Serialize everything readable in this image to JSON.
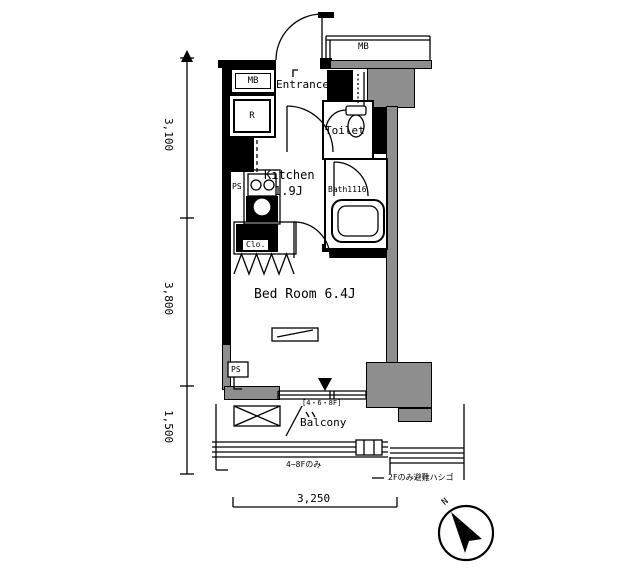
{
  "rooms": {
    "entrance": "Entrance",
    "toilet": "Toilet",
    "kitchen": "Kitchen",
    "kitchen_size": "1.9J",
    "bath": "Bath1116",
    "bedroom": "Bed Room 6.4J",
    "balcony": "Balcony",
    "balcony_floors": "[4・6・8F]"
  },
  "fixtures": {
    "mb_top": "MB",
    "mb_left": "MB",
    "refrigerator": "R",
    "ps_kitchen": "PS",
    "ps_bedroom": "PS",
    "closet": "Clo."
  },
  "dimensions": {
    "v1": "3,100",
    "v2": "3,800",
    "v3": "1,500",
    "h1": "3,250"
  },
  "notes": {
    "upper_floors": "4−8Fのみ",
    "ladder": "2Fのみ避難ハシゴ"
  },
  "compass": {
    "north": "N"
  },
  "colors": {
    "wall": "#000000",
    "column_fill": "#8e8e8e",
    "background": "#ffffff"
  }
}
